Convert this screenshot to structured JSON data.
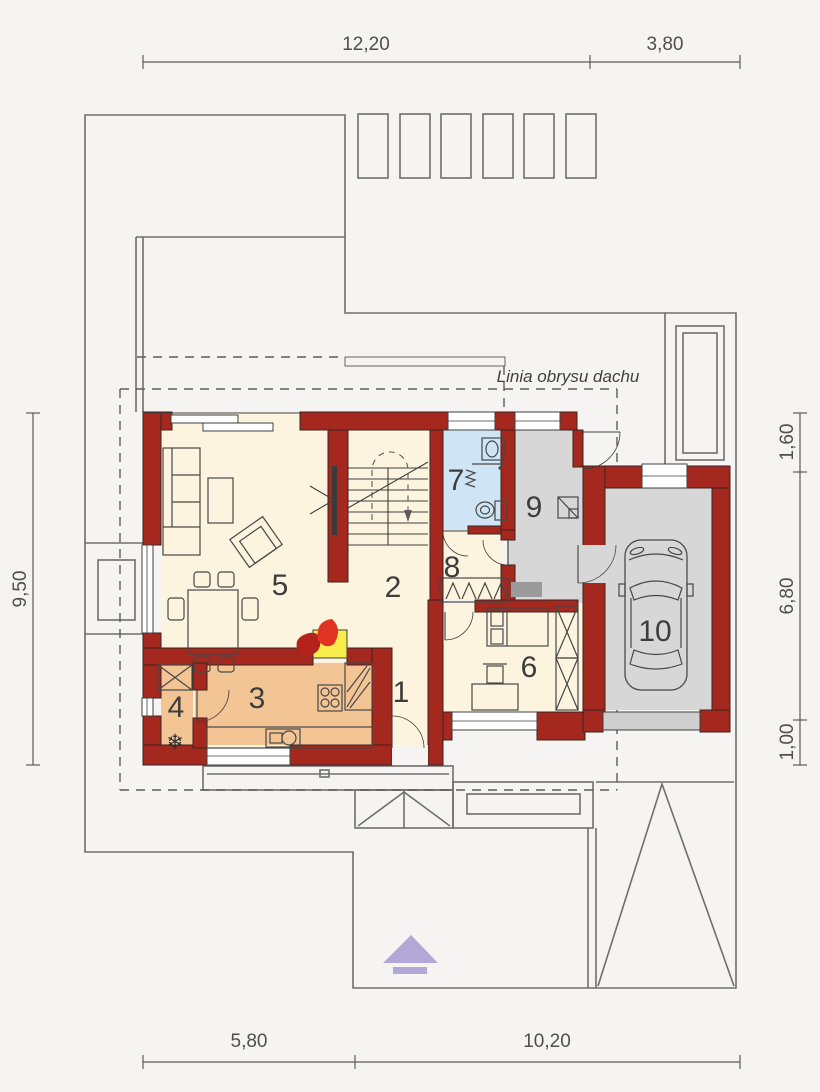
{
  "dimensions": {
    "top": [
      "12,20",
      "3,80"
    ],
    "bottom": [
      "5,80",
      "10,20"
    ],
    "left": [
      "9,50"
    ],
    "right": [
      "1,60",
      "6,80",
      "1,00"
    ]
  },
  "labels": {
    "roof_outline": "Linia obrysu dachu"
  },
  "rooms": [
    {
      "number": "1"
    },
    {
      "number": "2"
    },
    {
      "number": "3"
    },
    {
      "number": "4"
    },
    {
      "number": "5"
    },
    {
      "number": "6"
    },
    {
      "number": "7"
    },
    {
      "number": "8"
    },
    {
      "number": "9"
    },
    {
      "number": "10"
    }
  ],
  "icons": {
    "snowflake": "❄"
  },
  "colors": {
    "bg": "#f5f4f3",
    "wall": "#a5281f",
    "floor": "#fdf4e0",
    "kitchen": "#f3c494",
    "bath": "#cfe5f5",
    "garage": "#d7d7d7",
    "fireplace": "#f8ed4a",
    "flame": "#d22b20",
    "north_arrow": "#b2a7d6",
    "line": "#3f3f3f",
    "site_line": "#6e6e6e",
    "dim": "#5a5a5a"
  }
}
